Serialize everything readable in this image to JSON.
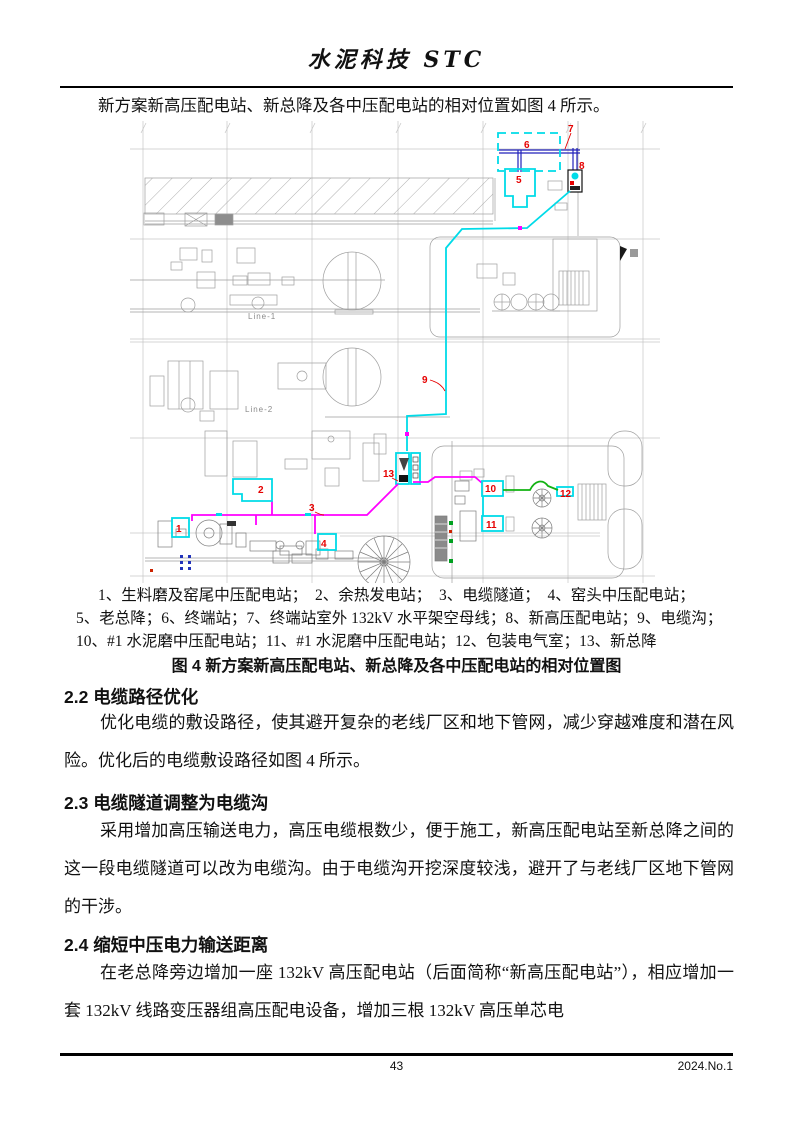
{
  "header": {
    "journal_title": "水泥科技 STC"
  },
  "intro": "新方案新高压配电站、新总降及各中压配电站的相对位置如图 4 所示。",
  "figure": {
    "markers": {
      "m1": "1",
      "m2": "2",
      "m3": "3",
      "m4": "4",
      "m5": "5",
      "m6": "6",
      "m7": "7",
      "m8": "8",
      "m9": "9",
      "m10": "10",
      "m11": "11",
      "m12": "12",
      "m13": "13"
    },
    "plan_labels": {
      "line1": "Line-1",
      "line2": "Line-2"
    },
    "legend_lines": [
      "1、生料磨及窑尾中压配电站；　2、余热发电站；　3、电缆隧道；　4、窑头中压配电站；",
      "5、老总降；6、终端站；7、终端站室外 132kV 水平架空母线；8、新高压配电站；9、电缆沟；",
      "10、#1 水泥磨中压配电站；11、#1 水泥磨中压配电站；12、包装电气室；13、新总降"
    ],
    "caption": "图 4 新方案新高压配电站、新总降及各中压配电站的相对位置图",
    "colors": {
      "route_cable_trench": "#00dbe8",
      "route_cable_tunnel": "#ff00ff",
      "route_mv_green": "#12b212",
      "overhead_bus_blue": "#2222bb",
      "marker_red": "#e60000",
      "station_box_cyan": "#00dbe8"
    }
  },
  "sections": [
    {
      "heading": "2.2 电缆路径优化",
      "paragraphs": [
        "优化电缆的敷设路径，使其避开复杂的老线厂区和地下管网，减少穿越难度和潜在风险。优化后的电缆敷设路径如图 4 所示。"
      ]
    },
    {
      "heading": "2.3 电缆隧道调整为电缆沟",
      "paragraphs": [
        "采用增加高压输送电力，高压电缆根数少，便于施工，新高压配电站至新总降之间的这一段电缆隧道可以改为电缆沟。由于电缆沟开挖深度较浅，避开了与老线厂区地下管网的干涉。"
      ]
    },
    {
      "heading": "2.4 缩短中压电力输送距离",
      "paragraphs": [
        "在老总降旁边增加一座 132kV 高压配电站（后面简称“新高压配电站”），相应增加一套 132kV 线路变压器组高压配电设备，增加三根 132kV 高压单芯电"
      ]
    }
  ],
  "footer": {
    "page_number": "43",
    "issue": "2024.No.1"
  }
}
